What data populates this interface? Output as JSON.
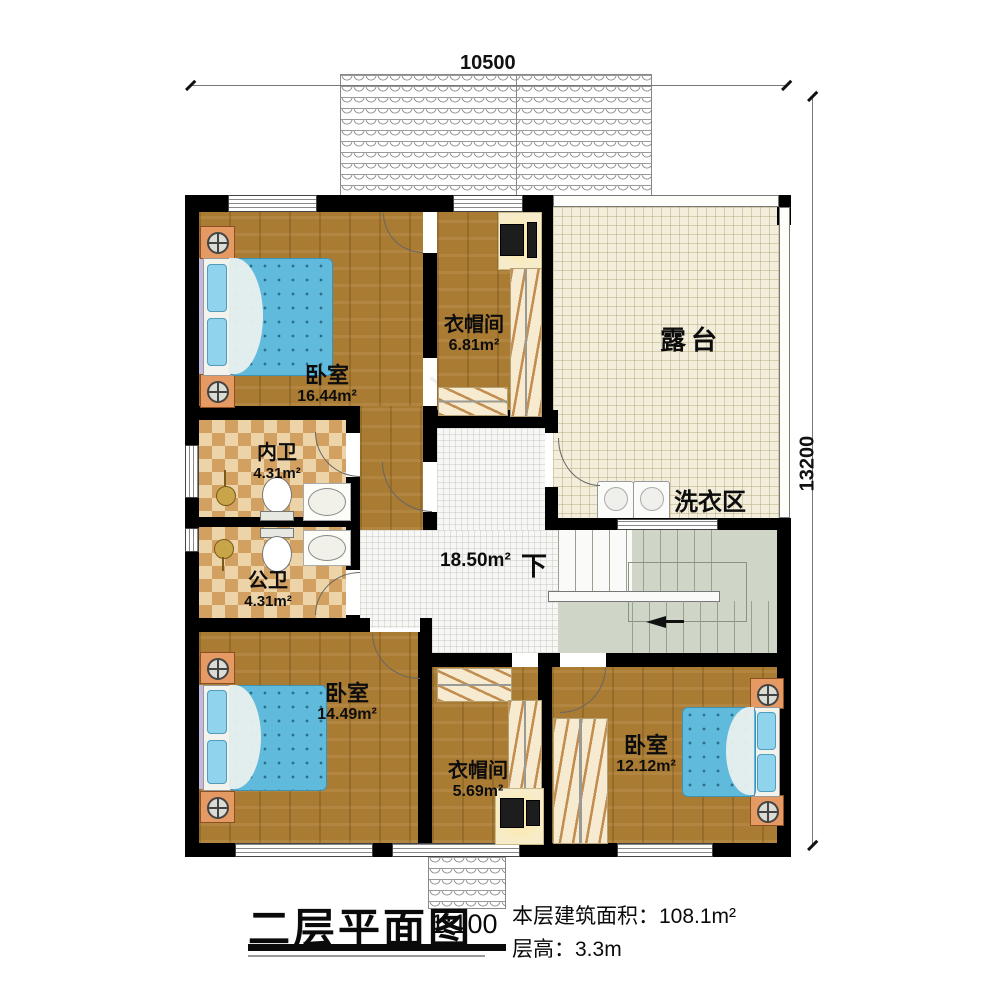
{
  "canvas": {
    "width": 1000,
    "height": 990
  },
  "dimensions": {
    "width_mm": "10500",
    "height_mm": "13200"
  },
  "rooms": {
    "bedroom1": {
      "name": "卧室",
      "area": "16.44m²"
    },
    "cloakroom1": {
      "name": "衣帽间",
      "area": "6.81m²"
    },
    "terrace": {
      "name": "露台"
    },
    "bath_inner": {
      "name": "内卫",
      "area": "4.31m²"
    },
    "bath_public": {
      "name": "公卫",
      "area": "4.31m²"
    },
    "hall": {
      "area": "18.50m²"
    },
    "stairs": {
      "down_label": "下"
    },
    "laundry": {
      "name": "洗衣区"
    },
    "bedroom2": {
      "name": "卧室",
      "area": "14.49m²"
    },
    "cloakroom2": {
      "name": "衣帽间",
      "area": "5.69m²"
    },
    "bedroom3": {
      "name": "卧室",
      "area": "12.12m²"
    }
  },
  "title_block": {
    "title": "二层平面图",
    "scale": "1:100",
    "area_label": "本层建筑面积：",
    "area_value": "108.1m²",
    "floor_height_label": "层高：",
    "floor_height_value": "3.3m"
  },
  "watermark": {
    "brand_char": "柏",
    "brand_text": "建筑",
    "url_fragment": "www.baij"
  },
  "colors": {
    "wall": "#000000",
    "wood_floor": "#a97b33",
    "bed_blue": "#5fbadb",
    "nightstand_orange": "#e59a64",
    "terrace_tile": "#f3eedb",
    "bath_tile_dark": "#d2a162",
    "bath_tile_light": "#ecd3a8",
    "stairs_green": "#cfd6c8",
    "hall_tile": "#f7f7f5"
  }
}
